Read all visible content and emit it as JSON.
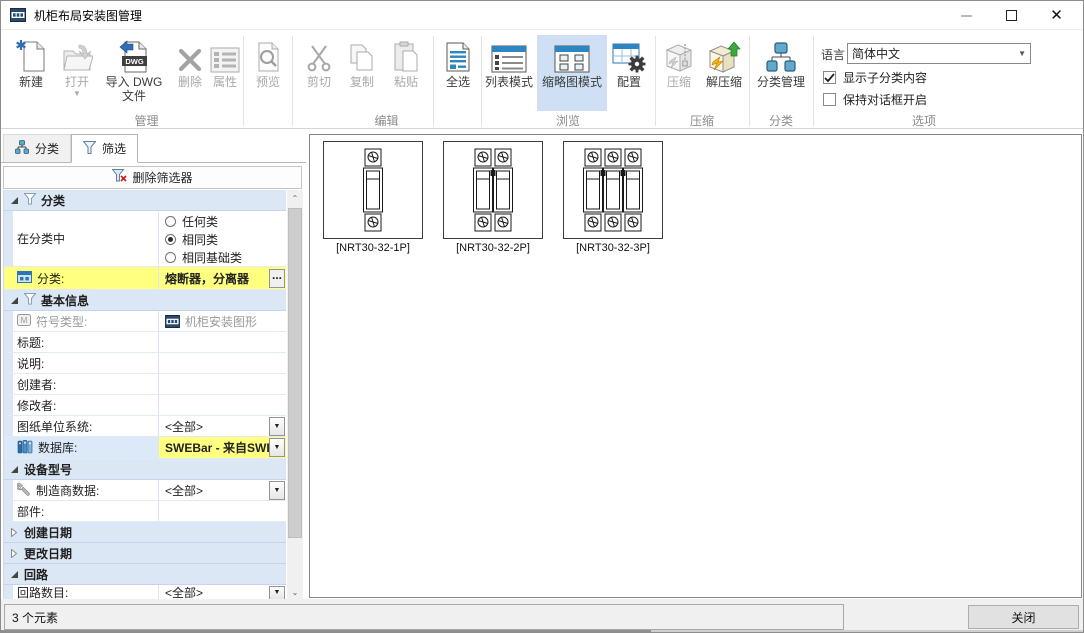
{
  "window": {
    "title": "机柜布局安装图管理"
  },
  "ribbon": {
    "buttons": {
      "new": "新建",
      "open": "打开",
      "import_dwg": "导入 DWG 文件",
      "delete": "删除",
      "properties": "属性",
      "preview": "预览",
      "cut": "剪切",
      "copy": "复制",
      "paste": "粘贴",
      "select_all": "全选",
      "list_mode": "列表模式",
      "thumbnail_mode": "缩略图模式",
      "configure": "配置",
      "compress": "压缩",
      "decompress": "解压缩",
      "category_manage": "分类管理"
    },
    "selected_button": "缩略图模式",
    "selected_bg": "#cfe0f5",
    "group_labels": {
      "manage": "管理",
      "edit": "编辑",
      "browse": "浏览",
      "compress": "压缩",
      "category": "分类",
      "options": "选项"
    },
    "options": {
      "language_label": "语言",
      "language_value": "简体中文",
      "show_subcategory": "显示子分类内容",
      "show_subcategory_checked": true,
      "keep_dialog_open": "保持对话框开启",
      "keep_dialog_open_checked": false
    }
  },
  "sidebar": {
    "tabs": [
      {
        "label": "分类"
      },
      {
        "label": "筛选"
      }
    ],
    "active_tab": "筛选",
    "delete_filter_label": "删除筛选器",
    "highlight_color": "#ffff80",
    "filter": {
      "category_section": {
        "header": "分类",
        "in_category_label": "在分类中",
        "radio_options": [
          "任何类",
          "相同类",
          "相同基础类"
        ],
        "radio_selected": "相同类",
        "category_label": "分类:",
        "category_value": "熔断器，分离器",
        "more_button": "..."
      },
      "basic_section": {
        "header": "基本信息",
        "symbol_type_label": "符号类型:",
        "symbol_type_value": "机柜安装图形",
        "title_label": "标题:",
        "description_label": "说明:",
        "creator_label": "创建者:",
        "modifier_label": "修改者:",
        "units_label": "图纸单位系统:",
        "units_value": "<全部>",
        "database_label": "数据库:",
        "database_value": "SWEBar - 来自SWE"
      },
      "device_section": {
        "header": "设备型号",
        "manufacturer_label": "制造商数据:",
        "manufacturer_value": "<全部>",
        "part_label": "部件:"
      },
      "created_section": {
        "header": "创建日期"
      },
      "modified_section": {
        "header": "更改日期"
      },
      "circuit_section": {
        "header": "回路",
        "count_label": "回路数目:",
        "count_value": "<全部>"
      }
    }
  },
  "main": {
    "thumbnails": [
      {
        "label": "[NRT30-32-1P]",
        "poles": 1
      },
      {
        "label": "[NRT30-32-2P]",
        "poles": 2
      },
      {
        "label": "[NRT30-32-3P]",
        "poles": 3
      }
    ]
  },
  "statusbar": {
    "count": "3 个元素",
    "close_label": "关闭"
  }
}
